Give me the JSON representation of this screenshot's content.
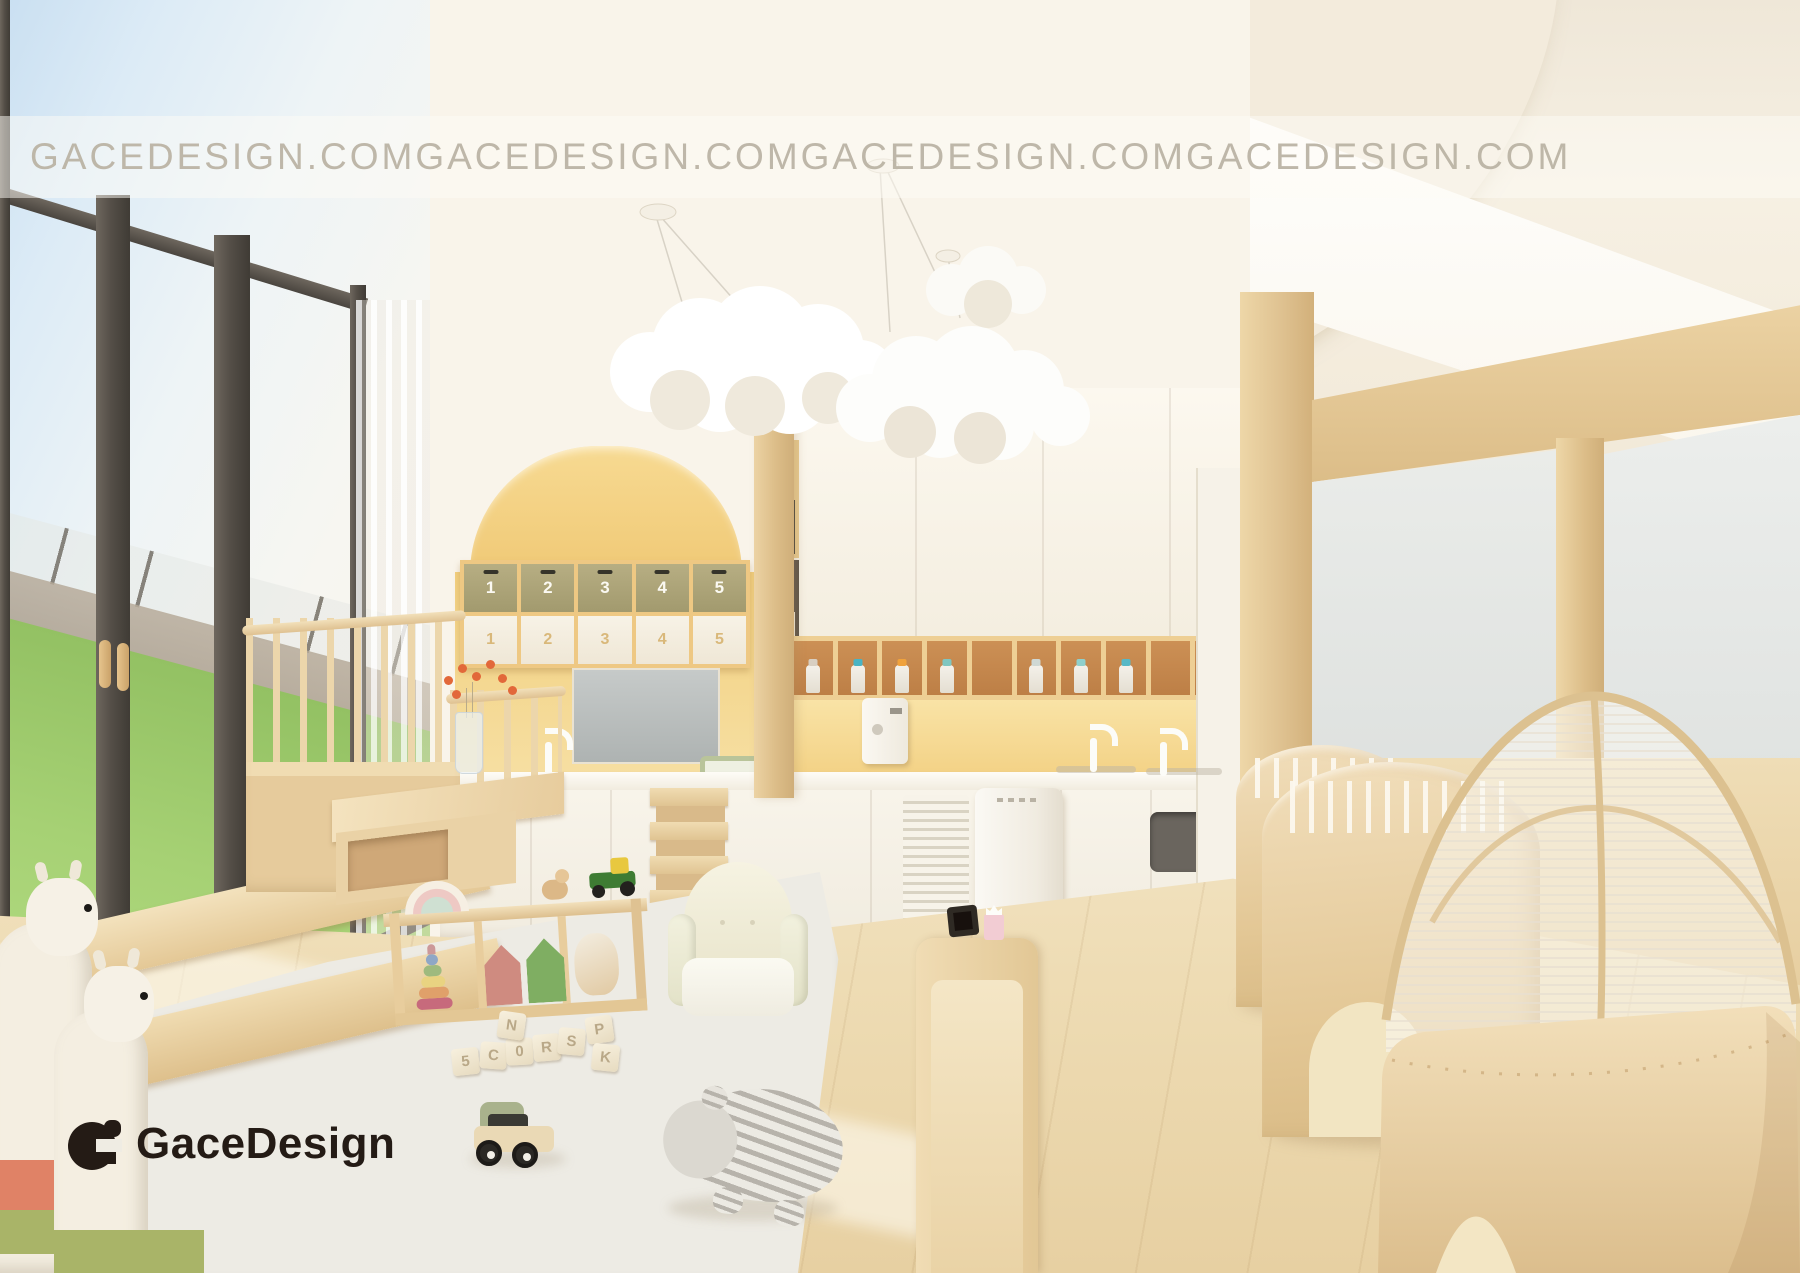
{
  "brand": {
    "watermark_text": "GACEDESIGN.COM",
    "logo_text": "GaceDesign"
  },
  "storage_niche": {
    "top_row_boxes": [
      "1",
      "2",
      "3",
      "4",
      "5"
    ],
    "bottom_row_boxes": [
      "1",
      "2",
      "3",
      "4",
      "5"
    ]
  },
  "toy_blocks": {
    "letters": [
      "5",
      "C",
      "0",
      "N",
      "R",
      "S",
      "P",
      "K"
    ]
  },
  "palette": {
    "accent_yellow": "#F2CF7E",
    "backsplash_yellow": "#F6DC9B",
    "wood_light": "#EAD3A8",
    "wall_cream": "#F7F1E6",
    "window_frame_dark": "#57524B",
    "grass_green": "#9AC768",
    "sky_blue": "#CDE2F2",
    "olive_box": "#A59D72",
    "rug_gray": "#ECEAE3",
    "watermark_color": "#BBB3A4",
    "logo_color": "#241B15"
  }
}
